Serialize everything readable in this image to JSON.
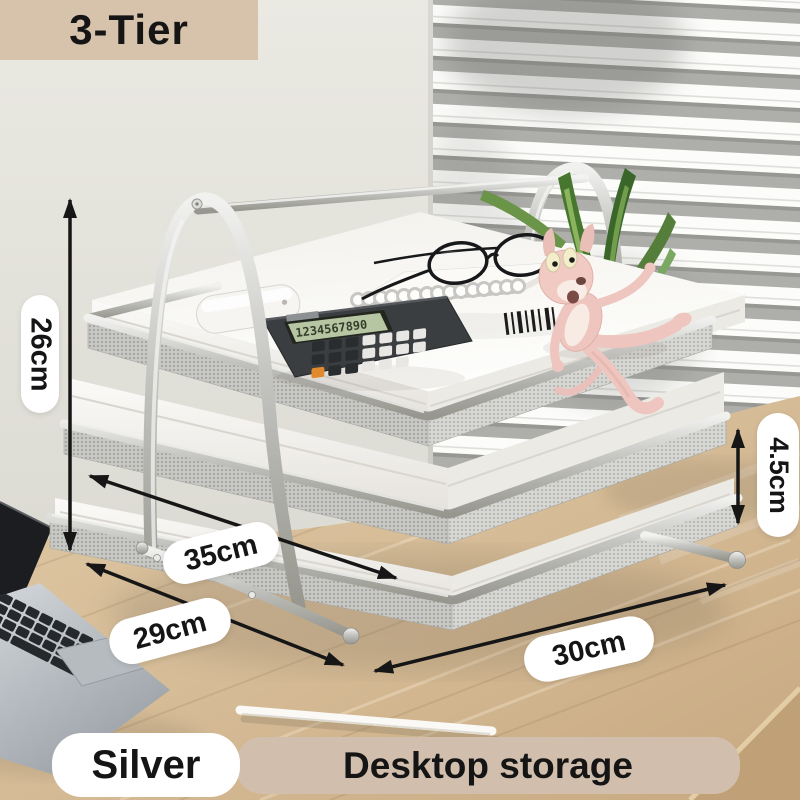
{
  "product": {
    "tier_badge": "3-Tier",
    "color_label": "Silver",
    "category_label": "Desktop storage",
    "scene_objects": [
      "3-tier mesh document tray",
      "laptop",
      "calculator",
      "spiral notebook",
      "eyeglasses",
      "pink panther figurine",
      "plant",
      "earbuds case",
      "stylus pen",
      "wood desk",
      "window blinds"
    ]
  },
  "dimensions": {
    "height": "26cm",
    "tray_length": "35cm",
    "base_depth": "29cm",
    "base_width": "30cm",
    "tier_gap": "4.5cm"
  },
  "calculator": {
    "display": "1234567890"
  },
  "colors": {
    "badge_bg": "#d7c2ab",
    "banner_bg": "#d2beac",
    "pill_bg": "#ffffff",
    "text": "#151515",
    "wall": "#e4e3db",
    "blinds_slat": "#aeaeab",
    "desk_wood": "#d8bf9d",
    "metal_silver": "#c3c3c0",
    "panther_pink": "#eec6bf",
    "plant_green": "#47762f"
  }
}
